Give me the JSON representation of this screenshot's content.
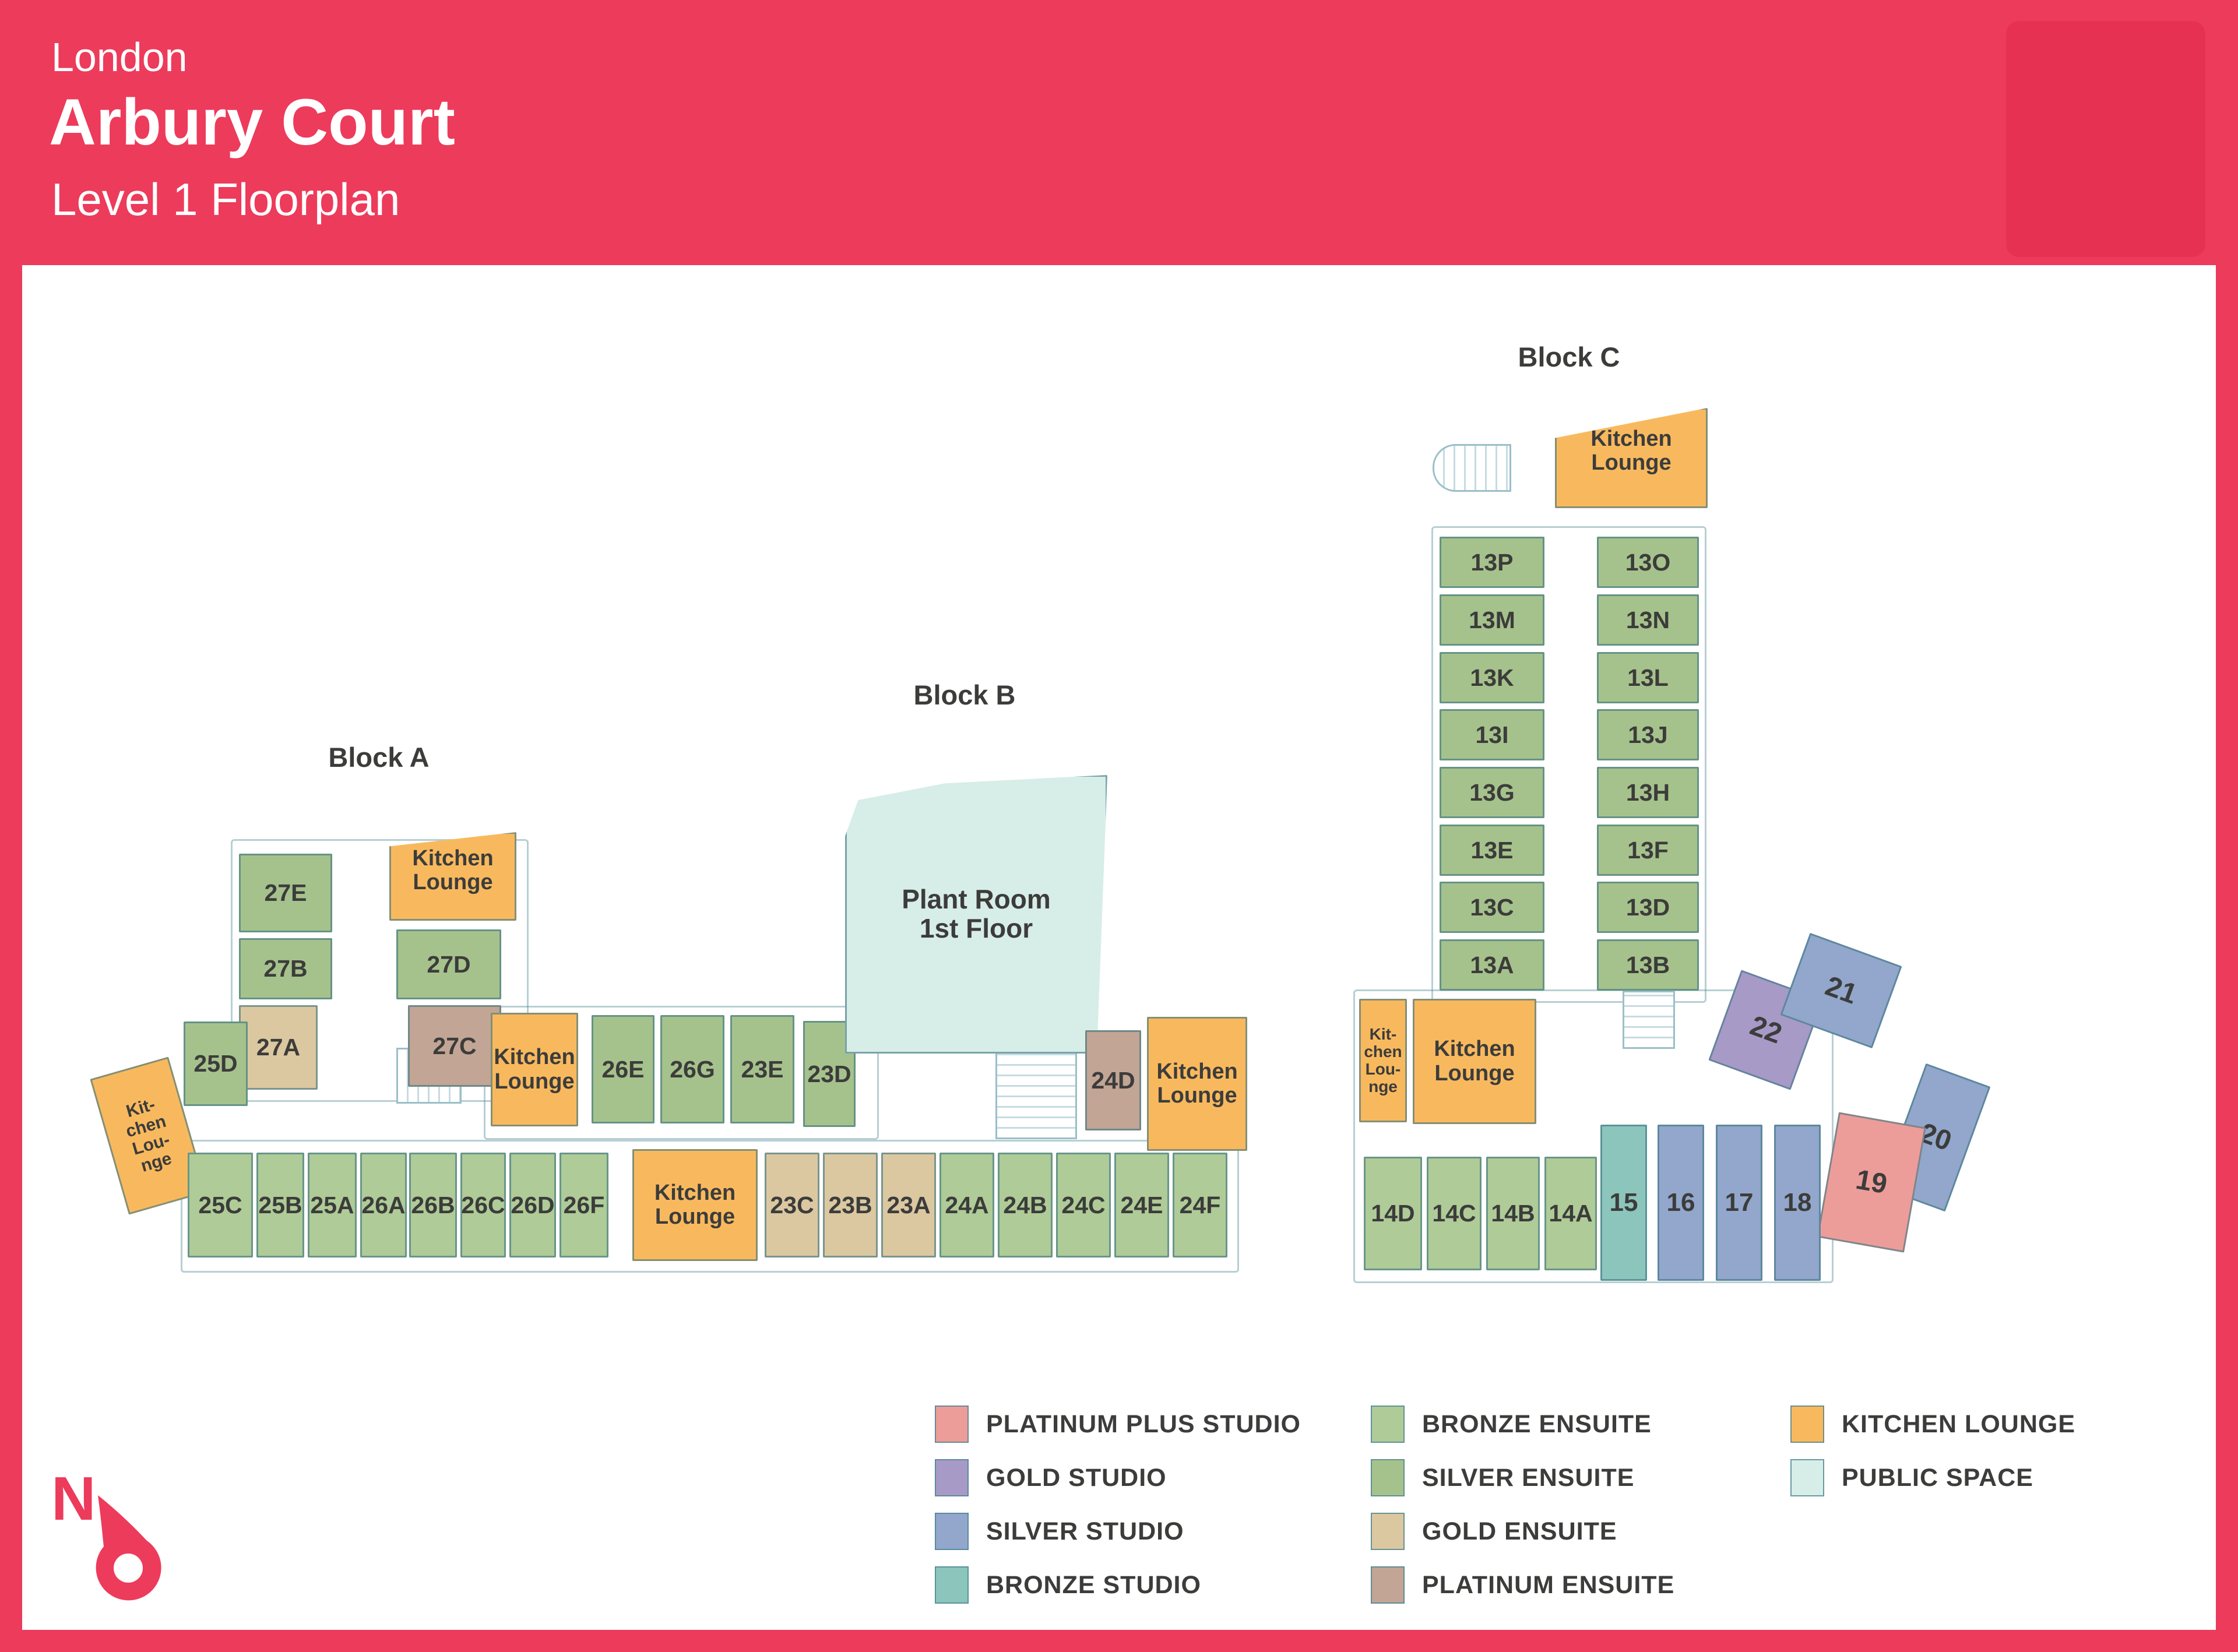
{
  "header": {
    "city": "London",
    "title": "Arbury Court",
    "subtitle": "Level 1 Floorplan"
  },
  "blocks": {
    "a": "Block A",
    "b": "Block B",
    "c": "Block C"
  },
  "north_label": "N",
  "colors": {
    "brand_red": "#ED3B5B",
    "wall_teal": "#4A8694",
    "text_dark": "#3C3C3B"
  },
  "legend": {
    "columns": [
      [
        {
          "type": "platinum_plus_studio",
          "label": "PLATINUM PLUS STUDIO",
          "color": "#EC9D99"
        },
        {
          "type": "gold_studio",
          "label": "GOLD STUDIO",
          "color": "#A79AC7"
        },
        {
          "type": "silver_studio",
          "label": "SILVER STUDIO",
          "color": "#92A7CB"
        },
        {
          "type": "bronze_studio",
          "label": "BRONZE STUDIO",
          "color": "#8CC5BB"
        }
      ],
      [
        {
          "type": "bronze_ensuite",
          "label": "BRONZE ENSUITE",
          "color": "#AFCB97"
        },
        {
          "type": "silver_ensuite",
          "label": "SILVER ENSUITE",
          "color": "#A6C28C"
        },
        {
          "type": "gold_ensuite",
          "label": "GOLD ENSUITE",
          "color": "#DBC8A0"
        },
        {
          "type": "platinum_ensuite",
          "label": "PLATINUM ENSUITE",
          "color": "#C2A594"
        }
      ],
      [
        {
          "type": "kitchen_lounge",
          "label": "KITCHEN LOUNGE",
          "color": "#F8B95E"
        },
        {
          "type": "public_space",
          "label": "PUBLIC SPACE",
          "color": "#D7EDE8"
        }
      ]
    ]
  },
  "rooms": [
    {
      "id": "27E",
      "label": "27E",
      "type": "silver_ensuite"
    },
    {
      "id": "27B",
      "label": "27B",
      "type": "silver_ensuite"
    },
    {
      "id": "27A",
      "label": "27A",
      "type": "gold_ensuite"
    },
    {
      "id": "kl_a_top",
      "label": "Kitchen\nLounge",
      "type": "kitchen_lounge"
    },
    {
      "id": "27D",
      "label": "27D",
      "type": "silver_ensuite"
    },
    {
      "id": "27C",
      "label": "27C",
      "type": "platinum_ensuite"
    },
    {
      "id": "25D",
      "label": "25D",
      "type": "silver_ensuite"
    },
    {
      "id": "kl_a_left",
      "label": "Kit-\nchen\nLou-\nnge",
      "type": "kitchen_lounge"
    },
    {
      "id": "kl_a_mid",
      "label": "Kitchen\nLounge",
      "type": "kitchen_lounge"
    },
    {
      "id": "26E",
      "label": "26E",
      "type": "silver_ensuite"
    },
    {
      "id": "26G",
      "label": "26G",
      "type": "silver_ensuite"
    },
    {
      "id": "23E",
      "label": "23E",
      "type": "silver_ensuite"
    },
    {
      "id": "23D",
      "label": "23D",
      "type": "silver_ensuite"
    },
    {
      "id": "25C",
      "label": "25C",
      "type": "bronze_ensuite"
    },
    {
      "id": "25B",
      "label": "25B",
      "type": "bronze_ensuite"
    },
    {
      "id": "25A",
      "label": "25A",
      "type": "bronze_ensuite"
    },
    {
      "id": "26A",
      "label": "26A",
      "type": "bronze_ensuite"
    },
    {
      "id": "26B",
      "label": "26B",
      "type": "bronze_ensuite"
    },
    {
      "id": "26C",
      "label": "26C",
      "type": "bronze_ensuite"
    },
    {
      "id": "26D",
      "label": "26D",
      "type": "bronze_ensuite"
    },
    {
      "id": "26F",
      "label": "26F",
      "type": "bronze_ensuite"
    },
    {
      "id": "kl_a_bottom",
      "label": "Kitchen\nLounge",
      "type": "kitchen_lounge"
    },
    {
      "id": "23C",
      "label": "23C",
      "type": "gold_ensuite"
    },
    {
      "id": "23B",
      "label": "23B",
      "type": "gold_ensuite"
    },
    {
      "id": "23A",
      "label": "23A",
      "type": "gold_ensuite"
    },
    {
      "id": "24A",
      "label": "24A",
      "type": "bronze_ensuite"
    },
    {
      "id": "24B",
      "label": "24B",
      "type": "bronze_ensuite"
    },
    {
      "id": "24C",
      "label": "24C",
      "type": "bronze_ensuite"
    },
    {
      "id": "24E",
      "label": "24E",
      "type": "bronze_ensuite"
    },
    {
      "id": "24F",
      "label": "24F",
      "type": "bronze_ensuite"
    },
    {
      "id": "plant",
      "label": "Plant Room\n1st Floor",
      "type": "public_space"
    },
    {
      "id": "24D",
      "label": "24D",
      "type": "platinum_ensuite"
    },
    {
      "id": "kl_b",
      "label": "Kitchen\nLounge",
      "type": "kitchen_lounge"
    },
    {
      "id": "kl_c_top",
      "label": "Kitchen\nLounge",
      "type": "kitchen_lounge"
    },
    {
      "id": "13P",
      "label": "13P",
      "type": "silver_ensuite"
    },
    {
      "id": "13O",
      "label": "13O",
      "type": "silver_ensuite"
    },
    {
      "id": "13M",
      "label": "13M",
      "type": "silver_ensuite"
    },
    {
      "id": "13N",
      "label": "13N",
      "type": "silver_ensuite"
    },
    {
      "id": "13K",
      "label": "13K",
      "type": "silver_ensuite"
    },
    {
      "id": "13L",
      "label": "13L",
      "type": "silver_ensuite"
    },
    {
      "id": "13I",
      "label": "13I",
      "type": "silver_ensuite"
    },
    {
      "id": "13J",
      "label": "13J",
      "type": "silver_ensuite"
    },
    {
      "id": "13G",
      "label": "13G",
      "type": "silver_ensuite"
    },
    {
      "id": "13H",
      "label": "13H",
      "type": "silver_ensuite"
    },
    {
      "id": "13E",
      "label": "13E",
      "type": "silver_ensuite"
    },
    {
      "id": "13F",
      "label": "13F",
      "type": "silver_ensuite"
    },
    {
      "id": "13C",
      "label": "13C",
      "type": "silver_ensuite"
    },
    {
      "id": "13D",
      "label": "13D",
      "type": "silver_ensuite"
    },
    {
      "id": "13A",
      "label": "13A",
      "type": "silver_ensuite"
    },
    {
      "id": "13B",
      "label": "13B",
      "type": "silver_ensuite"
    },
    {
      "id": "kl_c_narrow",
      "label": "Kit-\nchen\nLou-\nnge",
      "type": "kitchen_lounge"
    },
    {
      "id": "kl_c_main",
      "label": "Kitchen\nLounge",
      "type": "kitchen_lounge"
    },
    {
      "id": "22",
      "label": "22",
      "type": "gold_studio"
    },
    {
      "id": "21",
      "label": "21",
      "type": "silver_studio"
    },
    {
      "id": "20",
      "label": "20",
      "type": "silver_studio"
    },
    {
      "id": "19",
      "label": "19",
      "type": "platinum_plus_studio"
    },
    {
      "id": "14D",
      "label": "14D",
      "type": "bronze_ensuite"
    },
    {
      "id": "14C",
      "label": "14C",
      "type": "bronze_ensuite"
    },
    {
      "id": "14B",
      "label": "14B",
      "type": "bronze_ensuite"
    },
    {
      "id": "14A",
      "label": "14A",
      "type": "bronze_ensuite"
    },
    {
      "id": "15",
      "label": "15",
      "type": "bronze_studio"
    },
    {
      "id": "16",
      "label": "16",
      "type": "silver_studio"
    },
    {
      "id": "17",
      "label": "17",
      "type": "silver_studio"
    },
    {
      "id": "18",
      "label": "18",
      "type": "silver_studio"
    }
  ]
}
